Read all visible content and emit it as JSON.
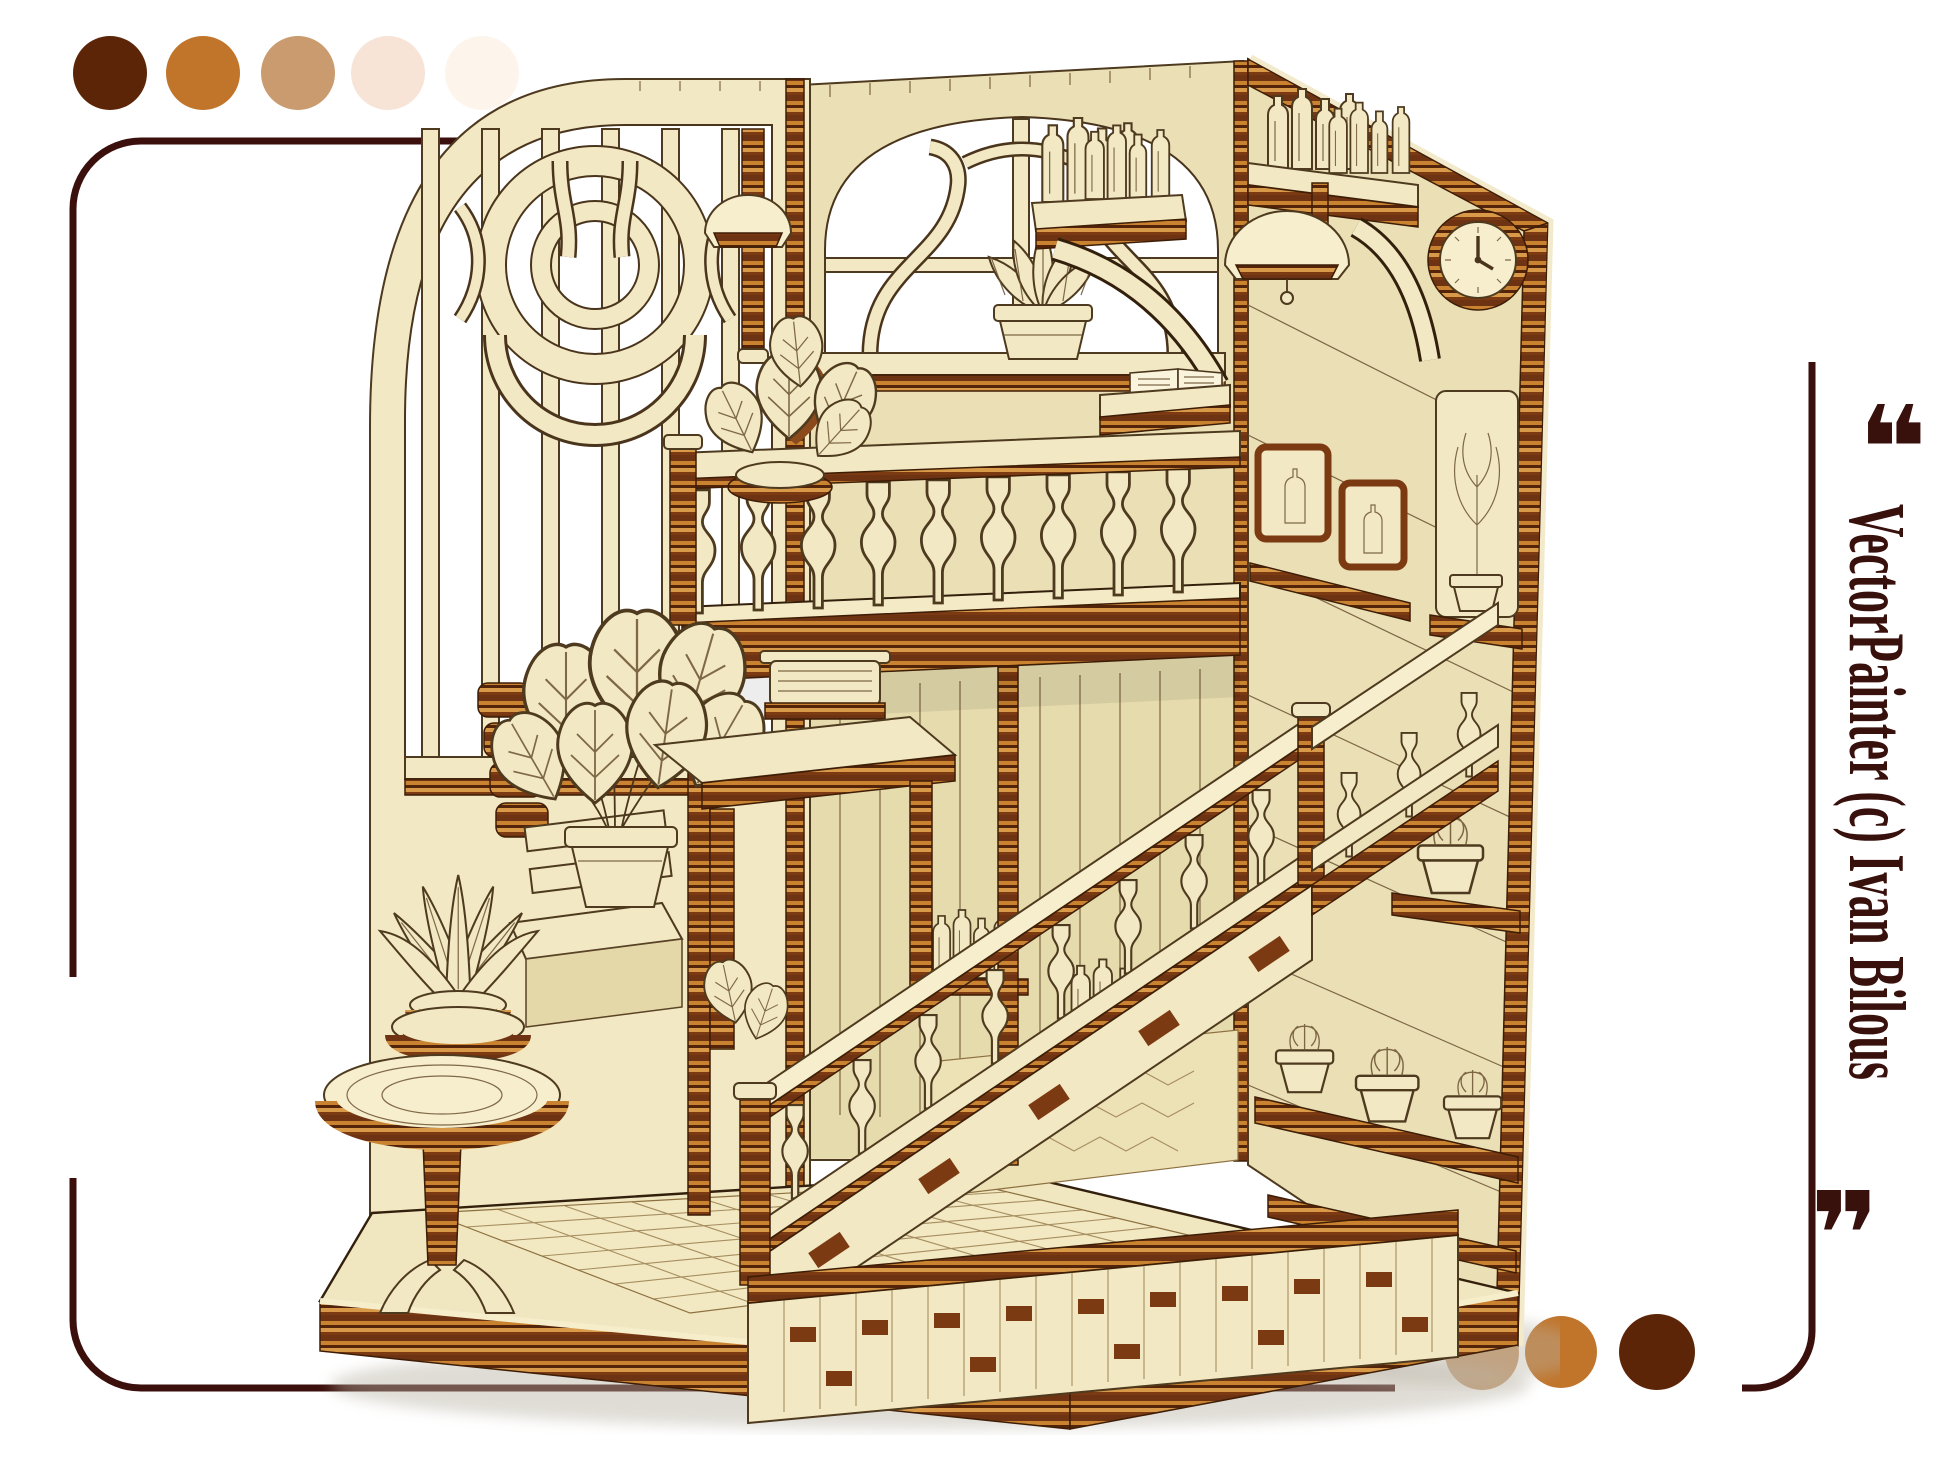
{
  "branding": {
    "open_quote": "❝",
    "author_credit": "VectorPainter (c) Ivan Bilous",
    "close_quote": "❞"
  },
  "frame": {
    "color": "#3B0F0C"
  },
  "palette_top": {
    "swatches": [
      "#5C2507",
      "#C0752B",
      "#C99B6E",
      "#F7E4D7",
      "#FDF4EC"
    ]
  },
  "palette_bottom": {
    "swatches": [
      "#C89A6C",
      "#C0752B",
      "#5C2507"
    ]
  },
  "illustration": {
    "label": "Laser-cut wooden book nook miniature room with arched Art-Nouveau windows, balcony, grand staircase, shelves, clock and plants",
    "wood_colors": {
      "plywood_face": "#F2E8C3",
      "edge_dark": "#6E3312",
      "edge_orange": "#C9822F"
    }
  }
}
